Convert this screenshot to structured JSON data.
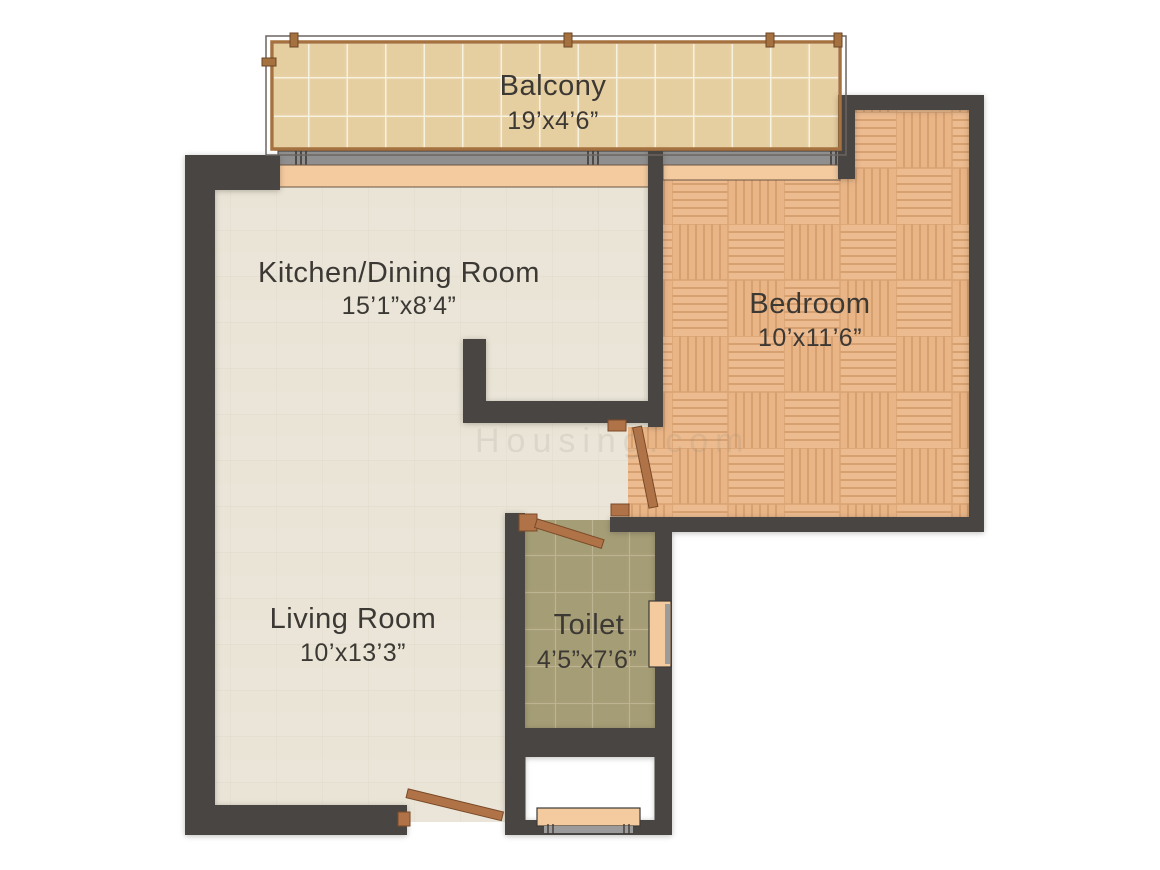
{
  "document": {
    "type": "apartment-floor-plan",
    "watermark": "Housing.com"
  },
  "rooms": {
    "balcony": {
      "name": "Balcony",
      "dimensions": "19’x4’6”"
    },
    "kitchen_dining": {
      "name": "Kitchen/Dining Room",
      "dimensions": "15’1”x8’4”"
    },
    "bedroom": {
      "name": "Bedroom",
      "dimensions": "10’x11’6”"
    },
    "living_room": {
      "name": "Living Room",
      "dimensions": "10’x13’3”"
    },
    "toilet": {
      "name": "Toilet",
      "dimensions": "4’5”x7’6”"
    }
  },
  "colors": {
    "wall": "#494542",
    "kitchen_living_floor": "#eae5d8",
    "bedroom_parquet": "#ecbb8f",
    "balcony_tile": "#e7d0a3",
    "toilet_tile": "#a89f78",
    "door_leaf": "#b07348",
    "window_sill": "#f4ca9f",
    "window_glass": "#8f8f8f",
    "label_text": "#3c3834"
  }
}
